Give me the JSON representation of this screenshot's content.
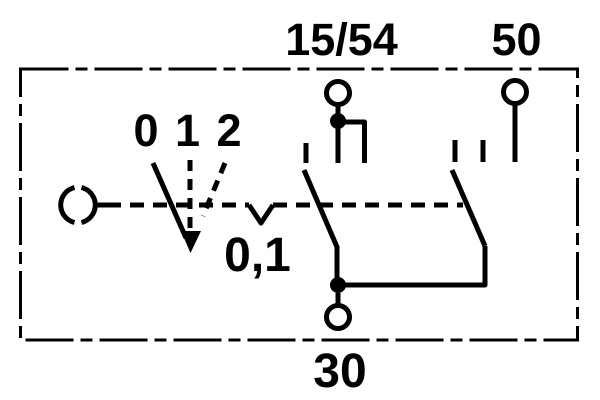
{
  "schematic": {
    "labels": {
      "terminal_15_54": "15/54",
      "terminal_50": "50",
      "terminal_30": "30",
      "positions": "0 1 2",
      "intermediate_position": "0,1"
    },
    "colors": {
      "ink": "#000000",
      "background": "#ffffff"
    }
  }
}
